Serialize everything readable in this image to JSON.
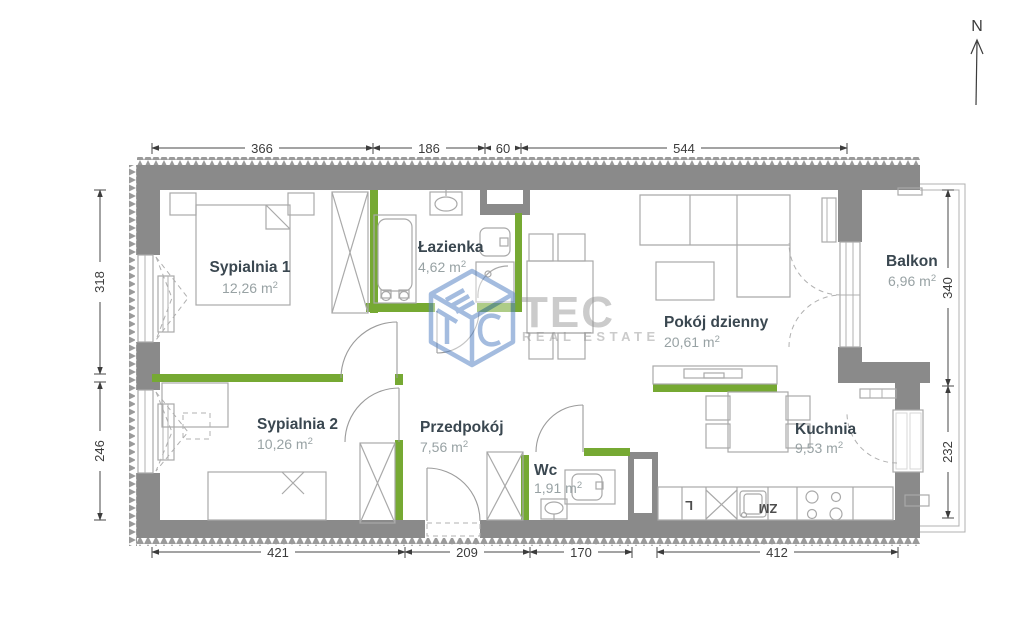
{
  "plan": {
    "rooms": [
      {
        "name": "Sypialnia 1",
        "area": "12,26"
      },
      {
        "name": "Łazienka",
        "area": "4,62"
      },
      {
        "name": "Pokój dzienny",
        "area": "20,61"
      },
      {
        "name": "Balkon",
        "area": "6,96"
      },
      {
        "name": "Sypialnia 2",
        "area": "10,26"
      },
      {
        "name": "Przedpokój",
        "area": "7,56"
      },
      {
        "name": "Wc",
        "area": "1,91"
      },
      {
        "name": "Kuchnia",
        "area": "9,53"
      }
    ],
    "units": {
      "m": " m",
      "sup": "2"
    },
    "dims": {
      "top": [
        "366",
        "186",
        "60",
        "544"
      ],
      "bottom": [
        "421",
        "209",
        "170",
        "412"
      ],
      "left": [
        "318",
        "246"
      ],
      "right": [
        "340",
        "232"
      ]
    },
    "fixtures": {
      "fridge": "L",
      "dishwasher": "ZM"
    },
    "compass": {
      "north": "N"
    },
    "watermark": {
      "brand": "TEC",
      "tagline": "REAL ESTATE"
    },
    "colors": {
      "wall": "#8a8a8a",
      "partition": "#76a933",
      "watermark_blue": "#5b87c5",
      "label_text": "#3a4750",
      "area_text": "#98a2a4"
    }
  }
}
